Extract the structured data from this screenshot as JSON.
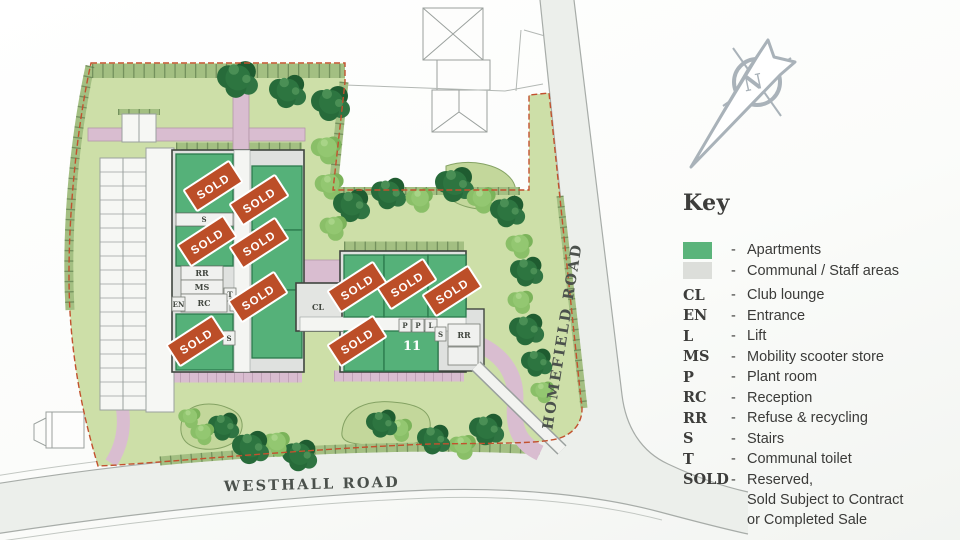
{
  "key": {
    "title": "Key",
    "dash": "-",
    "swatch_items": [
      {
        "label": "Apartments",
        "color": "#5bb47b"
      },
      {
        "label": "Communal / Staff areas",
        "color": "#dcdeda"
      }
    ],
    "abbr_items": [
      {
        "abbr": "CL",
        "label": "Club lounge"
      },
      {
        "abbr": "EN",
        "label": "Entrance"
      },
      {
        "abbr": "L",
        "label": "Lift"
      },
      {
        "abbr": "MS",
        "label": "Mobility scooter store"
      },
      {
        "abbr": "P",
        "label": "Plant room"
      },
      {
        "abbr": "RC",
        "label": "Reception"
      },
      {
        "abbr": "RR",
        "label": "Refuse & recycling"
      },
      {
        "abbr": "S",
        "label": "Stairs"
      },
      {
        "abbr": "T",
        "label": "Communal toilet"
      }
    ],
    "sold_item": {
      "abbr": "SOLD",
      "line1": "Reserved,",
      "line2": "Sold Subject to Contract",
      "line3": "or Completed Sale"
    }
  },
  "map": {
    "roads": {
      "bottom_label": "WESTHALL ROAD",
      "right_label": "HOMEFIELD ROAD"
    },
    "sold_badge": "SOLD",
    "unit_11": "11",
    "labels": {
      "cl": "CL",
      "en": "EN",
      "l": "L",
      "ms": "MS",
      "p": "P",
      "rc": "RC",
      "rr": "RR",
      "s": "S",
      "t": "T"
    },
    "compass_letter": "N"
  },
  "colors": {
    "apartments": "#5bb47b",
    "communal": "#dcdeda",
    "sold": "#bc4e28",
    "lawn": "#cddfa8",
    "hedge": "#a3bf82",
    "path_pink": "#d9bdd0",
    "tree_dark": "#2d6e3e",
    "tree_light": "#8abf68",
    "boundary_red": "#c2512e",
    "compass_grey": "#a9b2b9"
  }
}
